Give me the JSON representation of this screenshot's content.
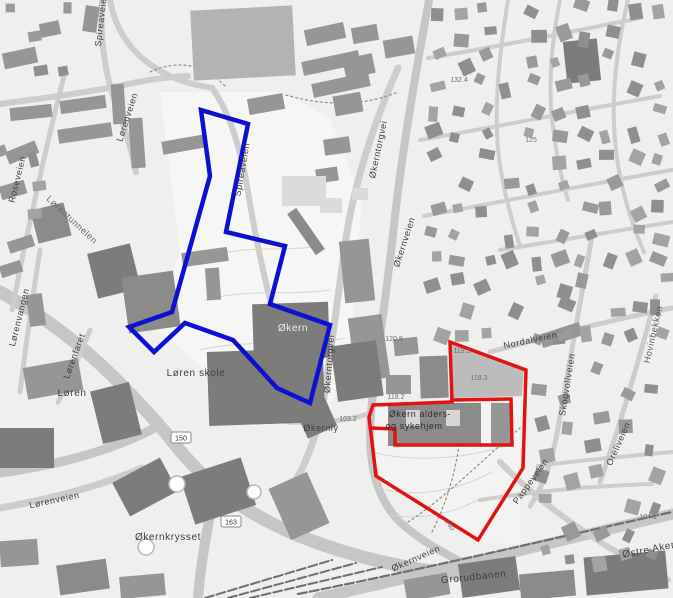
{
  "map": {
    "colors": {
      "bg": "#efefed",
      "road": "#cdcdcb",
      "road_major": "#c6c6c4",
      "rail": "#6e6e6e",
      "contour": "#d4d4d2",
      "accent_blue": "#0d10d2",
      "accent_red": "#e21212"
    },
    "shades": {
      "b": "#969695",
      "c": "#8b8b8a",
      "d": "#7c7c7b",
      "l": "#b3b3b1",
      "e": "#dbdbd9",
      "w": "#d6d6d4"
    },
    "fields": [
      {
        "pts": "160,92 282,92 330,118 362,200 352,330 332,402 300,424 232,392 158,330 180,250",
        "f": "#f6f6f4"
      },
      {
        "pts": "366,402 520,398 520,545 478,542 372,478",
        "f": "#f3f3f1"
      },
      {
        "pts": "452,344 524,368 522,396 452,398",
        "f": "#bcbcba"
      }
    ],
    "roads": [
      {
        "d": "M 0,292 C 70,330 120,380 165,432 C 200,478 235,508 290,532 C 350,558 420,572 470,575",
        "w": 13,
        "c": "#c6c6c4"
      },
      {
        "d": "M 318,598 C 420,576 520,550 673,514",
        "w": 11,
        "c": "#c6c6c4"
      },
      {
        "d": "M 160,425 C 120,448 60,465 0,473",
        "w": 9,
        "c": "#c6c6c4"
      },
      {
        "d": "M 212,505 C 205,540 200,570 198,598",
        "w": 10,
        "c": "#c6c6c4"
      },
      {
        "d": "M 429,0 C 416,70 402,150 394,225 C 386,300 376,360 371,412 C 368,455 372,492 398,520 C 418,540 450,558 492,576 L 540,594",
        "w": 8,
        "c": "#c6c6c4"
      },
      {
        "d": "M 398,68 C 375,120 355,180 346,238 C 338,295 332,340 326,385 C 321,420 310,462 288,492",
        "w": 7
      },
      {
        "d": "M 110,0 C 116,34 136,60 170,76 C 188,84 202,86 212,88",
        "w": 6
      },
      {
        "d": "M 212,88 C 228,110 238,140 246,180 C 254,230 264,280 278,330 C 286,358 294,380 302,398",
        "w": 6
      },
      {
        "d": "M 102,0 C 100,36 104,72 116,104 C 124,126 132,150 136,172",
        "w": 6
      },
      {
        "d": "M 0,104 C 45,98 90,92 128,84 C 150,79 170,77 188,76",
        "w": 6
      },
      {
        "d": "M 64,76 C 50,130 38,185 26,240 C 20,268 16,290 12,310",
        "w": 5
      },
      {
        "d": "M 40,250 C 32,300 26,345 20,392",
        "w": 5
      },
      {
        "d": "M 0,508 C 55,498 100,486 142,468",
        "w": 7
      },
      {
        "d": "M 90,330 C 80,354 70,378 58,402",
        "w": 5
      },
      {
        "d": "M 288,422 C 320,424 350,420 368,414",
        "w": 5
      },
      {
        "d": "M 490,352 C 550,336 610,320 672,308",
        "w": 5
      },
      {
        "d": "M 592,236 C 582,290 570,360 558,428 C 552,462 544,484 530,506",
        "w": 5
      },
      {
        "d": "M 656,296 C 640,356 622,420 600,482",
        "w": 5
      },
      {
        "d": "M 500,462 C 525,488 555,512 588,534 C 615,552 640,566 668,580",
        "w": 6
      },
      {
        "d": "M 508,0 C 500,50 494,100 498,150 C 502,185 510,215 520,246",
        "w": 4
      },
      {
        "d": "M 560,0 C 552,40 548,80 552,120 C 556,150 560,175 568,200",
        "w": 4
      },
      {
        "d": "M 628,0 C 616,50 610,100 616,150 C 620,185 630,220 644,252",
        "w": 4
      },
      {
        "d": "M 428,58 C 490,48 560,34 640,18",
        "w": 4
      },
      {
        "d": "M 420,140 C 490,128 570,112 660,96",
        "w": 4
      },
      {
        "d": "M 424,216 C 500,202 580,186 672,170",
        "w": 4
      },
      {
        "d": "M 500,250 C 560,240 620,230 672,222",
        "w": 4
      },
      {
        "d": "M 480,500 C 530,492 590,486 652,484",
        "w": 4
      },
      {
        "d": "M 538,466 C 580,460 630,456 672,452",
        "w": 4
      }
    ],
    "rails": [
      {
        "d": "M 298,594 C 400,574 520,546 672,512",
        "w": 2.2
      },
      {
        "d": "M 205,598 L 332,560",
        "w": 2
      },
      {
        "d": "M 228,598 L 356,563",
        "w": 2
      },
      {
        "d": "M 250,598 L 382,567",
        "w": 2
      }
    ],
    "contours": [
      "M 205,300 C 250,288 290,296 330,290",
      "M 200,350 C 250,338 300,348 345,338",
      "M 215,255 C 252,245 286,252 318,246",
      "M 372,452 C 410,462 460,460 505,446",
      "M 378,488 C 415,498 455,492 492,472",
      "M 390,515 C 420,520 450,514 478,500"
    ],
    "dotted": [
      "M 408,522 C 445,498 480,462 520,428",
      "M 432,532 C 452,492 460,452 462,416",
      "M 150,72 C 180,58 205,66 225,86",
      "M 286,95 C 330,108 370,104 398,92"
    ],
    "buildings": [
      [
        3,
        50,
        34,
        16,
        -12,
        "b"
      ],
      [
        40,
        22,
        20,
        14,
        -12,
        "b"
      ],
      [
        84,
        6,
        14,
        26,
        8,
        "b"
      ],
      [
        10,
        106,
        42,
        13,
        -6,
        "b"
      ],
      [
        60,
        98,
        46,
        13,
        -8,
        "b"
      ],
      [
        112,
        84,
        13,
        40,
        -4,
        "b"
      ],
      [
        58,
        126,
        54,
        14,
        -8,
        "b"
      ],
      [
        130,
        118,
        14,
        50,
        -4,
        "b"
      ],
      [
        162,
        138,
        44,
        13,
        -10,
        "b"
      ],
      [
        6,
        146,
        32,
        13,
        -22,
        "b"
      ],
      [
        0,
        183,
        26,
        14,
        -16,
        "b"
      ],
      [
        34,
        206,
        34,
        34,
        -14,
        "c"
      ],
      [
        92,
        248,
        44,
        46,
        -14,
        "d"
      ],
      [
        8,
        238,
        26,
        12,
        -18,
        "b"
      ],
      [
        0,
        263,
        22,
        12,
        -18,
        "b"
      ],
      [
        28,
        294,
        16,
        32,
        -8,
        "b"
      ],
      [
        125,
        274,
        52,
        56,
        -8,
        "c"
      ],
      [
        182,
        250,
        46,
        14,
        -8,
        "b"
      ],
      [
        206,
        268,
        14,
        32,
        -4,
        "b"
      ],
      [
        248,
        96,
        36,
        16,
        -10,
        "b"
      ],
      [
        305,
        26,
        40,
        16,
        -12,
        "b"
      ],
      [
        302,
        56,
        58,
        14,
        -12,
        "b"
      ],
      [
        312,
        78,
        58,
        14,
        -12,
        "b"
      ],
      [
        384,
        38,
        30,
        18,
        -10,
        "b"
      ],
      [
        352,
        26,
        26,
        16,
        -10,
        "b"
      ],
      [
        344,
        56,
        30,
        20,
        -12,
        "b"
      ],
      [
        334,
        94,
        28,
        20,
        -10,
        "b"
      ],
      [
        324,
        138,
        26,
        16,
        -8,
        "b"
      ],
      [
        316,
        168,
        22,
        14,
        -8,
        "b"
      ],
      [
        342,
        240,
        30,
        62,
        -6,
        "b"
      ],
      [
        352,
        316,
        34,
        64,
        -8,
        "b"
      ],
      [
        334,
        343,
        46,
        56,
        -8,
        "d"
      ],
      [
        253,
        303,
        76,
        56,
        -2,
        "d"
      ],
      [
        281,
        226,
        50,
        11,
        55,
        "c"
      ],
      [
        208,
        350,
        116,
        74,
        -2,
        "d"
      ],
      [
        298,
        392,
        32,
        42,
        -24,
        "d"
      ],
      [
        25,
        363,
        56,
        32,
        -10,
        "b"
      ],
      [
        0,
        428,
        54,
        40,
        0,
        "d"
      ],
      [
        96,
        386,
        40,
        54,
        -14,
        "d"
      ],
      [
        118,
        468,
        54,
        38,
        -28,
        "d"
      ],
      [
        186,
        466,
        64,
        50,
        -18,
        "d"
      ],
      [
        278,
        478,
        42,
        56,
        -24,
        "b"
      ],
      [
        58,
        562,
        50,
        30,
        -8,
        "c"
      ],
      [
        120,
        575,
        45,
        22,
        -5,
        "b"
      ],
      [
        0,
        540,
        38,
        26,
        -4,
        "b"
      ],
      [
        405,
        576,
        44,
        22,
        -10,
        "b"
      ],
      [
        460,
        560,
        58,
        34,
        -8,
        "d"
      ],
      [
        585,
        554,
        82,
        38,
        -5,
        "d"
      ],
      [
        520,
        572,
        55,
        26,
        -5,
        "c"
      ],
      [
        394,
        338,
        24,
        17,
        -6,
        "b"
      ],
      [
        420,
        356,
        28,
        42,
        -2,
        "c"
      ],
      [
        386,
        375,
        25,
        19,
        0,
        "b"
      ],
      [
        388,
        403,
        93,
        43,
        0,
        "c"
      ],
      [
        406,
        410,
        14,
        16,
        0,
        "w"
      ],
      [
        446,
        410,
        14,
        16,
        0,
        "w"
      ],
      [
        491,
        403,
        21,
        42,
        0,
        "b"
      ],
      [
        540,
        328,
        42,
        14,
        -18,
        "b"
      ],
      [
        565,
        40,
        34,
        42,
        -6,
        "d"
      ],
      [
        192,
        8,
        102,
        70,
        -3,
        "l"
      ],
      [
        282,
        176,
        44,
        30,
        0,
        "e"
      ],
      [
        320,
        198,
        22,
        15,
        0,
        "e"
      ],
      [
        352,
        188,
        16,
        12,
        0,
        "e"
      ]
    ],
    "house_regions": [
      {
        "x0": 430,
        "y0": 4,
        "x1": 666,
        "y1": 330,
        "gap": 25,
        "skip": 0.28,
        "seed": 11
      },
      {
        "x0": 536,
        "y0": 336,
        "x1": 668,
        "y1": 468,
        "gap": 27,
        "skip": 0.3,
        "seed": 22
      },
      {
        "x0": 540,
        "y0": 470,
        "x1": 670,
        "y1": 556,
        "gap": 27,
        "skip": 0.35,
        "seed": 33
      },
      {
        "x0": 2,
        "y0": 2,
        "x1": 92,
        "y1": 86,
        "gap": 30,
        "skip": 0.4,
        "seed": 44
      },
      {
        "x0": 0,
        "y0": 120,
        "x1": 60,
        "y1": 260,
        "gap": 30,
        "skip": 0.5,
        "seed": 55
      }
    ],
    "circles": [
      [
        177,
        484,
        8
      ],
      [
        146,
        547,
        8
      ],
      [
        254,
        492,
        7
      ]
    ],
    "annotations": {
      "blue": {
        "color": "#0d10d2",
        "width": 4.5,
        "points": "201,110 248,124 226,232 285,246 270,304 330,325 310,403 277,388 233,340 185,323 154,352 129,327 172,312 210,176"
      },
      "red": {
        "color": "#e21212",
        "width": 3.5,
        "outer": "450,342 526,370 523,468 478,540 376,476 369,417 373,405 452,402",
        "inner": "371,428 395,429 395,445 512,445 511,399 452,400"
      }
    },
    "labels": [
      {
        "t": "Spireaveien",
        "x": 104,
        "y": 20,
        "r": -83
      },
      {
        "t": "Lørenveien",
        "x": 130,
        "y": 118,
        "r": -72
      },
      {
        "t": "Spireaveien",
        "x": 245,
        "y": 170,
        "r": -80
      },
      {
        "t": "Roseveien",
        "x": 20,
        "y": 180,
        "r": -76
      },
      {
        "t": "Lørentunnelen",
        "x": 70,
        "y": 222,
        "r": 43,
        "c": "#6a6a6a"
      },
      {
        "t": "Lørenvangen",
        "x": 22,
        "y": 318,
        "r": -76
      },
      {
        "t": "Lørenfaret",
        "x": 77,
        "y": 357,
        "r": -70
      },
      {
        "t": "Løren",
        "x": 72,
        "y": 396,
        "s": 10
      },
      {
        "t": "Løren skole",
        "x": 196,
        "y": 376,
        "s": 10
      },
      {
        "t": "Lørenveien",
        "x": 55,
        "y": 503,
        "r": -12
      },
      {
        "t": "Økernly",
        "x": 321,
        "y": 431
      },
      {
        "t": "Økern",
        "x": 293,
        "y": 331,
        "c": "#ececea",
        "s": 10
      },
      {
        "t": "Økerntorgvei",
        "x": 381,
        "y": 150,
        "r": -78
      },
      {
        "t": "Økerntorgvei",
        "x": 332,
        "y": 364,
        "r": -86
      },
      {
        "t": "Økernveien",
        "x": 407,
        "y": 243,
        "r": -72
      },
      {
        "t": "Økernveien",
        "x": 417,
        "y": 561,
        "r": -24
      },
      {
        "t": "Økernkrysset",
        "x": 168,
        "y": 540,
        "s": 10
      },
      {
        "t": "Grorudbanen",
        "x": 474,
        "y": 580,
        "r": -6,
        "s": 10
      },
      {
        "t": "Østre Aker vei",
        "x": 658,
        "y": 551,
        "r": -11,
        "s": 10
      },
      {
        "t": "Nordalveien",
        "x": 531,
        "y": 343,
        "r": -12
      },
      {
        "t": "Skogvollveien",
        "x": 570,
        "y": 385,
        "r": -81
      },
      {
        "t": "Oreliveien",
        "x": 621,
        "y": 445,
        "r": -66
      },
      {
        "t": "Hovinbekken",
        "x": 656,
        "y": 335,
        "r": -77,
        "c": "#5a5a5a"
      },
      {
        "t": "Pappeveien",
        "x": 533,
        "y": 483,
        "r": -54
      },
      {
        "t": "Økern alders-",
        "x": 420,
        "y": 417,
        "c": "#2e2e2e",
        "n": "poi-label"
      },
      {
        "t": "og sykehjem",
        "x": 414,
        "y": 429,
        "c": "#2e2e2e",
        "n": "poi-label"
      },
      {
        "t": "120.8",
        "x": 394,
        "y": 341,
        "s": 7,
        "c": "#6f6f6f",
        "ls": 0,
        "n": "elevation-label"
      },
      {
        "t": "119.3",
        "x": 462,
        "y": 353,
        "s": 7,
        "c": "#6f6f6f",
        "ls": 0,
        "n": "elevation-label"
      },
      {
        "t": "118.3",
        "x": 479,
        "y": 380,
        "s": 7,
        "c": "#6f6f6f",
        "ls": 0,
        "n": "elevation-label"
      },
      {
        "t": "118.2",
        "x": 396,
        "y": 399,
        "s": 7,
        "c": "#6f6f6f",
        "ls": 0,
        "n": "elevation-label"
      },
      {
        "t": "103.2",
        "x": 348,
        "y": 421,
        "s": 7,
        "c": "#6f6f6f",
        "ls": 0,
        "n": "elevation-label"
      },
      {
        "t": "104.1",
        "x": 648,
        "y": 519,
        "s": 7,
        "c": "#6f6f6f",
        "ls": 0,
        "n": "elevation-label"
      },
      {
        "t": "132.4",
        "x": 459,
        "y": 82,
        "s": 7,
        "c": "#6f6f6f",
        "ls": 0,
        "n": "elevation-label"
      },
      {
        "t": "125",
        "x": 531,
        "y": 142,
        "s": 7,
        "c": "#6f6f6f",
        "ls": 0,
        "n": "elevation-label"
      },
      {
        "t": "160",
        "x": 448,
        "y": 526,
        "r": 58,
        "s": 7,
        "c": "#6f6f6f",
        "ls": 0,
        "n": "elevation-label"
      }
    ],
    "shields": [
      {
        "t": "150",
        "x": 181,
        "y": 438
      },
      {
        "t": "163",
        "x": 231,
        "y": 522
      }
    ]
  }
}
